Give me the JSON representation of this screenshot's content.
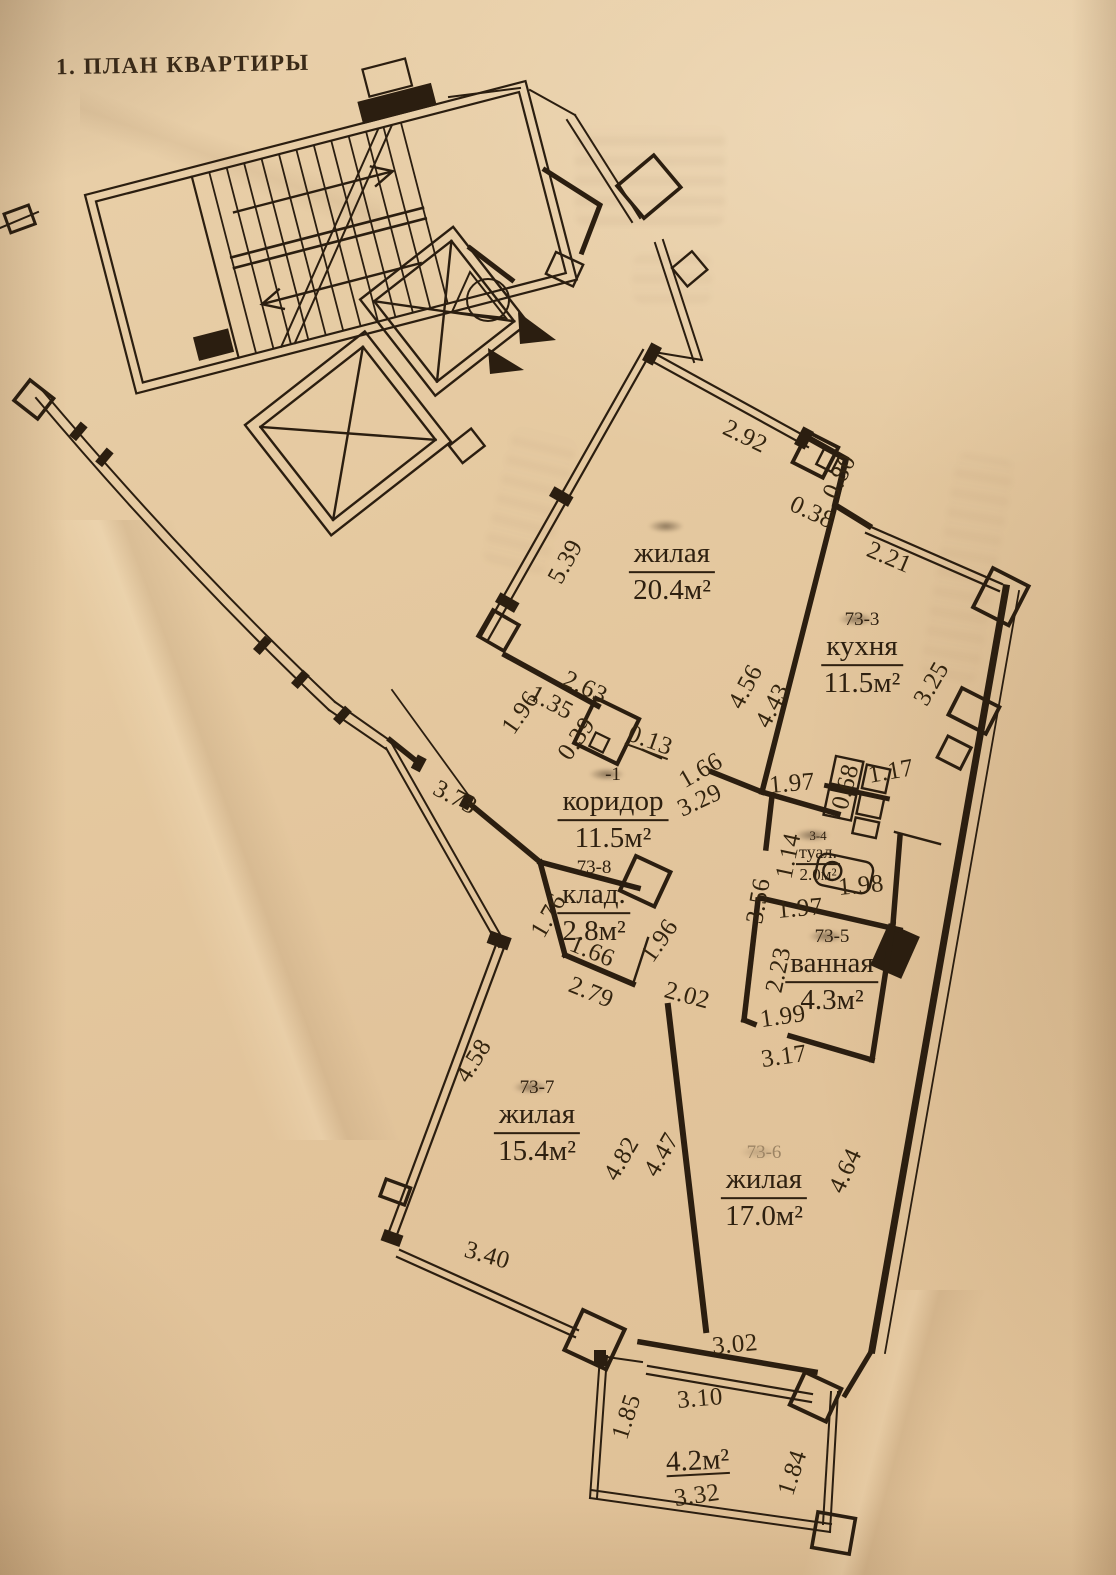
{
  "title": "1. ПЛАН КВАРТИРЫ",
  "colors": {
    "paper": "#e5c9a0",
    "ink": "#2b1e10"
  },
  "plan": {
    "rooms": [
      {
        "id": "living-room-20",
        "number": "",
        "name": "жилая",
        "area": "20.4м²",
        "x": 672,
        "y": 562,
        "smudge": true
      },
      {
        "id": "kitchen",
        "number": "73-3",
        "name": "кухня",
        "area": "11.5м²",
        "x": 862,
        "y": 655,
        "smudge": true
      },
      {
        "id": "corridor",
        "number": "-1",
        "name": "коридор",
        "area": "11.5м²",
        "x": 613,
        "y": 810,
        "smudge": true
      },
      {
        "id": "toilet",
        "number": "3-4",
        "name": "туал.",
        "area": "2.0м²",
        "x": 818,
        "y": 857,
        "small": true,
        "smudge": true
      },
      {
        "id": "bathroom",
        "number": "73-5",
        "name": "ванная",
        "area": "4.3м²",
        "x": 832,
        "y": 972,
        "smudge": true
      },
      {
        "id": "closet",
        "number": "73-8",
        "name": "клад.",
        "area": "2.8м²",
        "x": 594,
        "y": 903
      },
      {
        "id": "living-room-15",
        "number": "73-7",
        "name": "жилая",
        "area": "15.4м²",
        "x": 537,
        "y": 1123,
        "smudge": true
      },
      {
        "id": "living-room-17",
        "number": "73-6",
        "name": "жилая",
        "area": "17.0м²",
        "x": 764,
        "y": 1188,
        "smudge": true,
        "faint": true
      },
      {
        "id": "balcony",
        "number": "",
        "name": "",
        "area": "4.2м²",
        "x": 697,
        "y": 1450,
        "rot": -3,
        "area_underline": true
      }
    ],
    "dimensions": [
      {
        "v": "2.92",
        "x": 745,
        "y": 437,
        "rot": 26
      },
      {
        "v": "0.80",
        "x": 840,
        "y": 477,
        "rot": -64
      },
      {
        "v": "0.38",
        "x": 812,
        "y": 513,
        "rot": 25
      },
      {
        "v": "2.21",
        "x": 889,
        "y": 558,
        "rot": 23
      },
      {
        "v": "5.39",
        "x": 566,
        "y": 562,
        "rot": -61
      },
      {
        "v": "3.25",
        "x": 932,
        "y": 684,
        "rot": -60
      },
      {
        "v": "4.56",
        "x": 746,
        "y": 687,
        "rot": -62
      },
      {
        "v": "4.43",
        "x": 773,
        "y": 706,
        "rot": -62
      },
      {
        "v": "2.63",
        "x": 585,
        "y": 688,
        "rot": 25
      },
      {
        "v": "1.96",
        "x": 521,
        "y": 713,
        "rot": -55
      },
      {
        "v": "1.35",
        "x": 551,
        "y": 703,
        "rot": 28
      },
      {
        "v": "0.39",
        "x": 577,
        "y": 739,
        "rot": -55
      },
      {
        "v": "0.13",
        "x": 650,
        "y": 741,
        "rot": 20,
        "u": true
      },
      {
        "v": "1.66",
        "x": 701,
        "y": 771,
        "rot": -30
      },
      {
        "v": "3.29",
        "x": 700,
        "y": 801,
        "rot": -25
      },
      {
        "v": "1.97",
        "x": 792,
        "y": 784,
        "rot": -5
      },
      {
        "v": "0.68",
        "x": 846,
        "y": 787,
        "rot": -75
      },
      {
        "v": "1.17",
        "x": 891,
        "y": 772,
        "rot": -10
      },
      {
        "v": "1.14",
        "x": 789,
        "y": 856,
        "rot": -78
      },
      {
        "v": "1.98",
        "x": 861,
        "y": 886,
        "rot": -5
      },
      {
        "v": "3.56",
        "x": 759,
        "y": 901,
        "rot": -80
      },
      {
        "v": "1.97",
        "x": 800,
        "y": 909,
        "rot": -5
      },
      {
        "v": "2.23",
        "x": 779,
        "y": 970,
        "rot": -78
      },
      {
        "v": "1.99",
        "x": 783,
        "y": 1017,
        "rot": -8
      },
      {
        "v": "3.17",
        "x": 784,
        "y": 1057,
        "rot": -8
      },
      {
        "v": "1.76",
        "x": 549,
        "y": 916,
        "rot": -60
      },
      {
        "v": "1.66",
        "x": 592,
        "y": 952,
        "rot": 22
      },
      {
        "v": "1.96",
        "x": 660,
        "y": 941,
        "rot": -55
      },
      {
        "v": "2.79",
        "x": 591,
        "y": 993,
        "rot": 22
      },
      {
        "v": "2.02",
        "x": 687,
        "y": 996,
        "rot": 15
      },
      {
        "v": "3.73",
        "x": 455,
        "y": 798,
        "rot": 28
      },
      {
        "v": "4.58",
        "x": 474,
        "y": 1061,
        "rot": -58
      },
      {
        "v": "4.82",
        "x": 622,
        "y": 1159,
        "rot": -60
      },
      {
        "v": "4.47",
        "x": 662,
        "y": 1155,
        "rot": -60
      },
      {
        "v": "4.64",
        "x": 846,
        "y": 1171,
        "rot": -65
      },
      {
        "v": "3.40",
        "x": 487,
        "y": 1256,
        "rot": 16
      },
      {
        "v": "3.02",
        "x": 735,
        "y": 1345,
        "rot": -5
      },
      {
        "v": "3.10",
        "x": 700,
        "y": 1399,
        "rot": -5
      },
      {
        "v": "1.85",
        "x": 627,
        "y": 1417,
        "rot": -72
      },
      {
        "v": "3.32",
        "x": 697,
        "y": 1496,
        "rot": -8
      },
      {
        "v": "1.84",
        "x": 793,
        "y": 1473,
        "rot": -72
      }
    ]
  }
}
